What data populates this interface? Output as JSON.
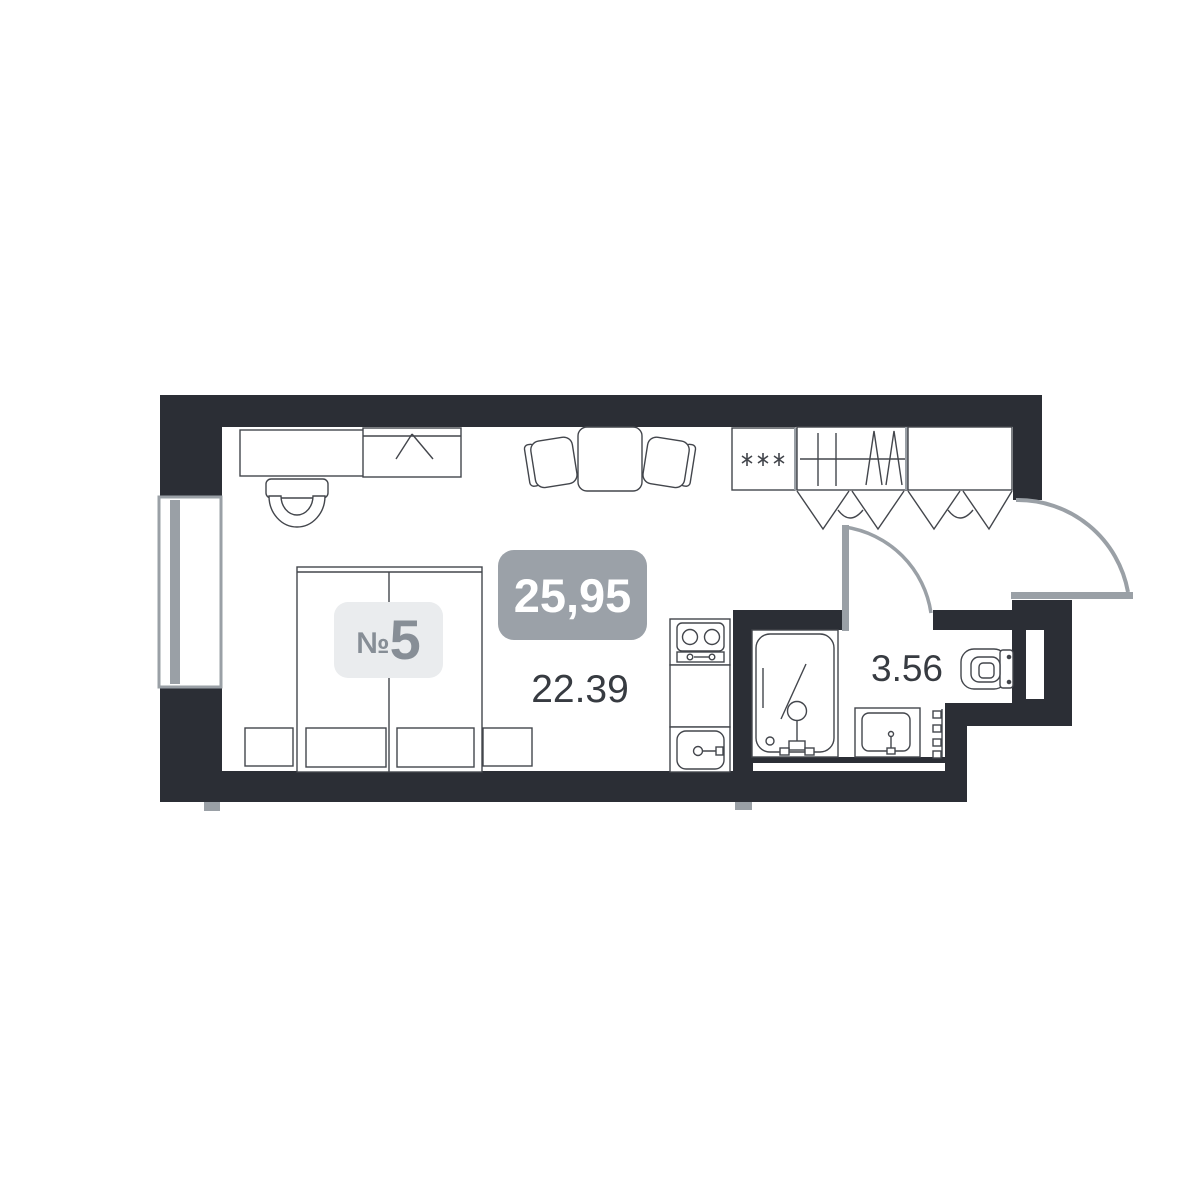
{
  "plan": {
    "unit": {
      "prefix": "№",
      "number": "5"
    },
    "total_area": "25,95",
    "rooms": [
      {
        "name": "main-room",
        "area": "22.39"
      },
      {
        "name": "bathroom",
        "area": "3.56"
      }
    ]
  },
  "colors": {
    "wall": "#2b2e35",
    "line": "#43464c",
    "door_gray": "#9aa0a6",
    "total_badge_bg": "#9ba1a8",
    "total_badge_text": "#ffffff",
    "unit_badge_bg": "#eaecee",
    "unit_badge_text": "#878e96",
    "area_text": "#373b41"
  }
}
